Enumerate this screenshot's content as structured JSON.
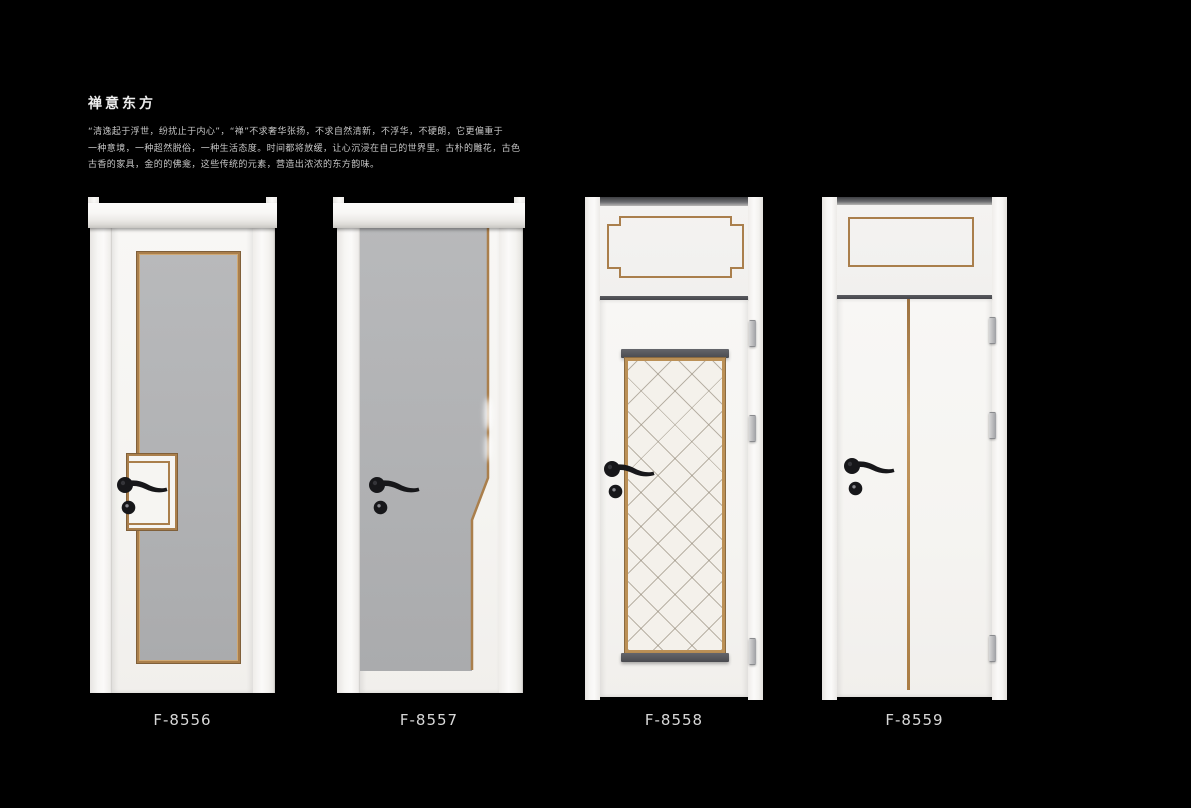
{
  "header": {
    "title": "禅意东方",
    "description": "“清逸起于浮世，纷扰止于内心”，“禅”不求奢华张扬，不求自然清新，不浮华，不硬朗，它更偏重于\n一种意境，一种超然脱俗，一种生活态度。时间都将放缓，让心沉浸在自己的世界里。古朴的雕花，古色\n古香的家具，金的的佛龛，这些传统的元素，营造出浓浓的东方韵味。"
  },
  "products": [
    {
      "model": "F-8556"
    },
    {
      "model": "F-8557"
    },
    {
      "model": "F-8558"
    },
    {
      "model": "F-8559"
    }
  ],
  "colors": {
    "bg": "#000000",
    "door_white": "#f6f5f2",
    "panel_gray": "#b2b3b5",
    "trim_gold": "#aa7f4c",
    "glass_white": "#f4f1eb",
    "hardware_black": "#17171a",
    "cap_dark": "#55565c",
    "label_text": "#d8d8d8",
    "body_text": "#c6c6c6",
    "title_text": "#ededed"
  }
}
